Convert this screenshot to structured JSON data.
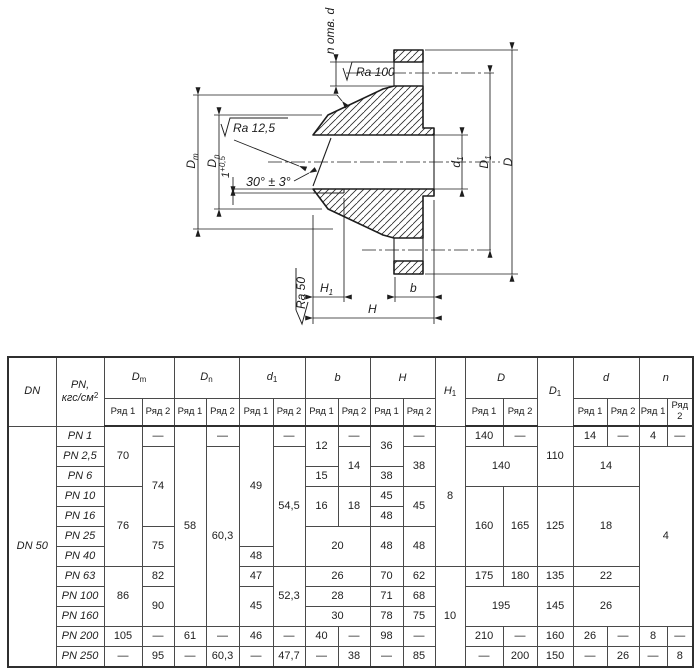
{
  "drawing": {
    "labels": {
      "n_holes": "n отв. d",
      "ra100": "Ra 100",
      "ra125": "Ra 12,5",
      "ra50": "Ra 50",
      "angle": "30° ± 3°",
      "tol_main": "1",
      "tol_sup": "+0,5",
      "dm_m": "D",
      "dm_sub": "m",
      "dn_m": "D",
      "dn_sub": "n",
      "d1_m": "d",
      "d1_sub": "1",
      "D1_m": "D",
      "D1_sub": "1",
      "D_m": "D",
      "H_m": "H",
      "H1_m": "H",
      "H1_sub": "1",
      "b_m": "b"
    },
    "line_color": "#1d1d1d"
  },
  "table": {
    "col_widths": [
      48,
      48,
      38,
      32,
      32,
      33,
      34,
      32,
      33,
      32,
      33,
      32,
      30,
      38,
      34,
      36,
      34,
      32,
      28,
      26
    ],
    "header_row1": [
      {
        "m": "DN",
        "rs": 2
      },
      {
        "m": "PN,",
        "line2": "кгс/см",
        "sup": "2",
        "rs": 2
      },
      {
        "m": "D",
        "sub": "m",
        "cs": 2
      },
      {
        "m": "D",
        "sub": "n",
        "cs": 2
      },
      {
        "m": "d",
        "sub": "1",
        "cs": 2
      },
      {
        "m": "b",
        "cs": 2
      },
      {
        "m": "H",
        "cs": 2
      },
      {
        "m": "H",
        "sub": "1",
        "rs": 2
      },
      {
        "m": "D",
        "cs": 2
      },
      {
        "m": "D",
        "sub": "1",
        "rs": 2
      },
      {
        "m": "d",
        "cs": 2
      },
      {
        "m": "n",
        "cs": 2
      }
    ],
    "subheaders": [
      "Ряд 1",
      "Ряд 2",
      "Ряд 1",
      "Ряд 2",
      "Ряд 1",
      "Ряд 2",
      "Ряд 1",
      "Ряд 2",
      "Ряд 1",
      "Ряд 2",
      "Ряд 1",
      "Ряд 2",
      "Ряд 1",
      "Ряд 2",
      "Ряд 1",
      "Ряд 2"
    ],
    "rows": [
      [
        {
          "t": "DN 50",
          "rs": 12,
          "i": 1
        },
        {
          "t": "PN 1",
          "i": 1
        },
        {
          "t": "70",
          "rs": 3
        },
        {
          "t": "—"
        },
        {
          "t": "58",
          "rs": 10
        },
        {
          "t": "—"
        },
        {
          "t": "49",
          "rs": 6
        },
        {
          "t": "—"
        },
        {
          "t": "12",
          "rs": 2
        },
        {
          "t": "—"
        },
        {
          "t": "36",
          "rs": 2
        },
        {
          "t": "—"
        },
        {
          "t": "8",
          "rs": 7
        },
        {
          "t": "140"
        },
        {
          "t": "—"
        },
        {
          "t": "110",
          "rs": 3
        },
        {
          "t": "14"
        },
        {
          "t": "—"
        },
        {
          "t": "4"
        },
        {
          "t": "—"
        }
      ],
      [
        {
          "t": "PN 2,5",
          "i": 1
        },
        {
          "t": "74",
          "rs": 4
        },
        {
          "t": "60,3",
          "rs": 9
        },
        {
          "t": "54,5",
          "rs": 6
        },
        {
          "t": "14",
          "rs": 2
        },
        {
          "t": "38",
          "rs": 2
        },
        {
          "t": "140",
          "rs": 2,
          "cs": 2
        },
        {
          "t": "14",
          "rs": 2,
          "cs": 2
        },
        {
          "t": "4",
          "rs": 9,
          "cs": 2
        }
      ],
      [
        {
          "t": "PN 6",
          "i": 1
        },
        {
          "t": "15"
        },
        {
          "t": "38"
        }
      ],
      [
        {
          "t": "PN 10",
          "i": 1
        },
        {
          "t": "76",
          "rs": 4
        },
        {
          "t": "16",
          "rs": 2
        },
        {
          "t": "18",
          "rs": 2
        },
        {
          "t": "45"
        },
        {
          "t": "45",
          "rs": 2
        },
        {
          "t": "160",
          "rs": 4
        },
        {
          "t": "165",
          "rs": 4
        },
        {
          "t": "125",
          "rs": 4
        },
        {
          "t": "18",
          "rs": 4,
          "cs": 2
        }
      ],
      [
        {
          "t": "PN 16",
          "i": 1
        },
        {
          "t": "48"
        }
      ],
      [
        {
          "t": "PN 25",
          "i": 1
        },
        {
          "t": "75",
          "rs": 2
        },
        {
          "t": "20",
          "rs": 2,
          "cs": 2
        },
        {
          "t": "48",
          "rs": 2
        },
        {
          "t": "48",
          "rs": 2
        }
      ],
      [
        {
          "t": "PN 40",
          "i": 1
        },
        {
          "t": "48"
        }
      ],
      [
        {
          "t": "PN 63",
          "i": 1
        },
        {
          "t": "86",
          "rs": 3
        },
        {
          "t": "82"
        },
        {
          "t": "47"
        },
        {
          "t": "52,3",
          "rs": 3
        },
        {
          "t": "26",
          "cs": 2
        },
        {
          "t": "70"
        },
        {
          "t": "62"
        },
        {
          "t": "10",
          "rs": 5
        },
        {
          "t": "175"
        },
        {
          "t": "180"
        },
        {
          "t": "135"
        },
        {
          "t": "22",
          "cs": 2
        }
      ],
      [
        {
          "t": "PN 100",
          "i": 1
        },
        {
          "t": "90",
          "rs": 2
        },
        {
          "t": "45",
          "rs": 2
        },
        {
          "t": "28",
          "cs": 2
        },
        {
          "t": "71"
        },
        {
          "t": "68"
        },
        {
          "t": "195",
          "rs": 2,
          "cs": 2
        },
        {
          "t": "145",
          "rs": 2
        },
        {
          "t": "26",
          "rs": 2,
          "cs": 2
        }
      ],
      [
        {
          "t": "PN 160",
          "i": 1
        },
        {
          "t": "30",
          "cs": 2
        },
        {
          "t": "78"
        },
        {
          "t": "75"
        }
      ],
      [
        {
          "t": "PN 200",
          "i": 1
        },
        {
          "t": "105"
        },
        {
          "t": "—"
        },
        {
          "t": "61"
        },
        {
          "t": "—"
        },
        {
          "t": "46"
        },
        {
          "t": "—"
        },
        {
          "t": "40"
        },
        {
          "t": "—"
        },
        {
          "t": "98"
        },
        {
          "t": "—"
        },
        {
          "t": "210"
        },
        {
          "t": "—"
        },
        {
          "t": "160"
        },
        {
          "t": "26"
        },
        {
          "t": "—"
        },
        {
          "t": "8"
        },
        {
          "t": "—"
        }
      ],
      [
        {
          "t": "PN 250",
          "i": 1
        },
        {
          "t": "—"
        },
        {
          "t": "95"
        },
        {
          "t": "—"
        },
        {
          "t": "60,3"
        },
        {
          "t": "—"
        },
        {
          "t": "47,7"
        },
        {
          "t": "—"
        },
        {
          "t": "38"
        },
        {
          "t": "—"
        },
        {
          "t": "85"
        },
        {
          "t": "—"
        },
        {
          "t": "200"
        },
        {
          "t": "150"
        },
        {
          "t": "—"
        },
        {
          "t": "26"
        },
        {
          "t": "—"
        },
        {
          "t": "8"
        }
      ]
    ]
  }
}
